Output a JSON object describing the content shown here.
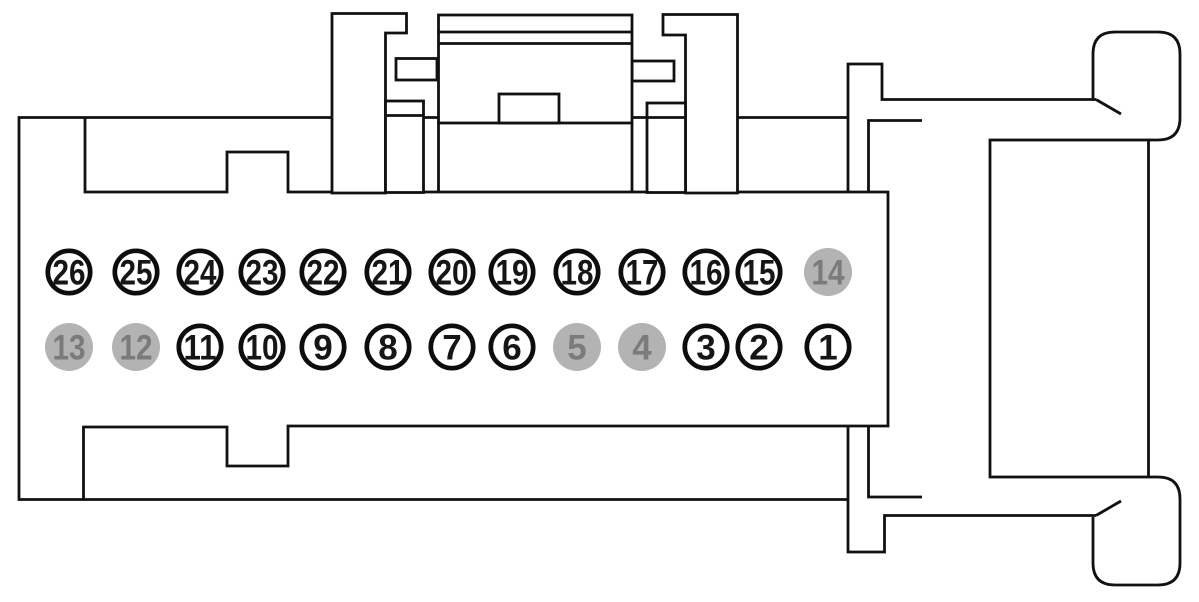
{
  "diagram": {
    "title": "26-pin connector pinout diagram",
    "description": "Side profile outline of a wiring harness connector with latch arms, mating end, and 26 numbered pin positions in two rows",
    "colors": {
      "background": "#ffffff",
      "line": "#111111",
      "pin_open_fill": "#ffffff",
      "pin_open_ring": "#0d0d0d",
      "pin_open_text": "#161616",
      "pin_blocked_fill": "#b3b3b3",
      "pin_blocked_text": "#7b7b7b"
    },
    "pin_rows": [
      {
        "name": "top",
        "pins": [
          {
            "label": "26",
            "blocked": false
          },
          {
            "label": "25",
            "blocked": false
          },
          {
            "label": "24",
            "blocked": false
          },
          {
            "label": "23",
            "blocked": false
          },
          {
            "label": "22",
            "blocked": false
          },
          {
            "label": "21",
            "blocked": false
          },
          {
            "label": "20",
            "blocked": false
          },
          {
            "label": "19",
            "blocked": false
          },
          {
            "label": "18",
            "blocked": false
          },
          {
            "label": "17",
            "blocked": false
          },
          {
            "label": "16",
            "blocked": false
          },
          {
            "label": "15",
            "blocked": false
          },
          {
            "label": "14",
            "blocked": true
          }
        ]
      },
      {
        "name": "bottom",
        "pins": [
          {
            "label": "13",
            "blocked": true
          },
          {
            "label": "12",
            "blocked": true
          },
          {
            "label": "11",
            "blocked": false
          },
          {
            "label": "10",
            "blocked": false
          },
          {
            "label": "9",
            "blocked": false
          },
          {
            "label": "8",
            "blocked": false
          },
          {
            "label": "7",
            "blocked": false
          },
          {
            "label": "6",
            "blocked": false
          },
          {
            "label": "5",
            "blocked": true
          },
          {
            "label": "4",
            "blocked": true
          },
          {
            "label": "3",
            "blocked": false
          },
          {
            "label": "2",
            "blocked": false
          },
          {
            "label": "1",
            "blocked": false
          }
        ]
      }
    ]
  }
}
